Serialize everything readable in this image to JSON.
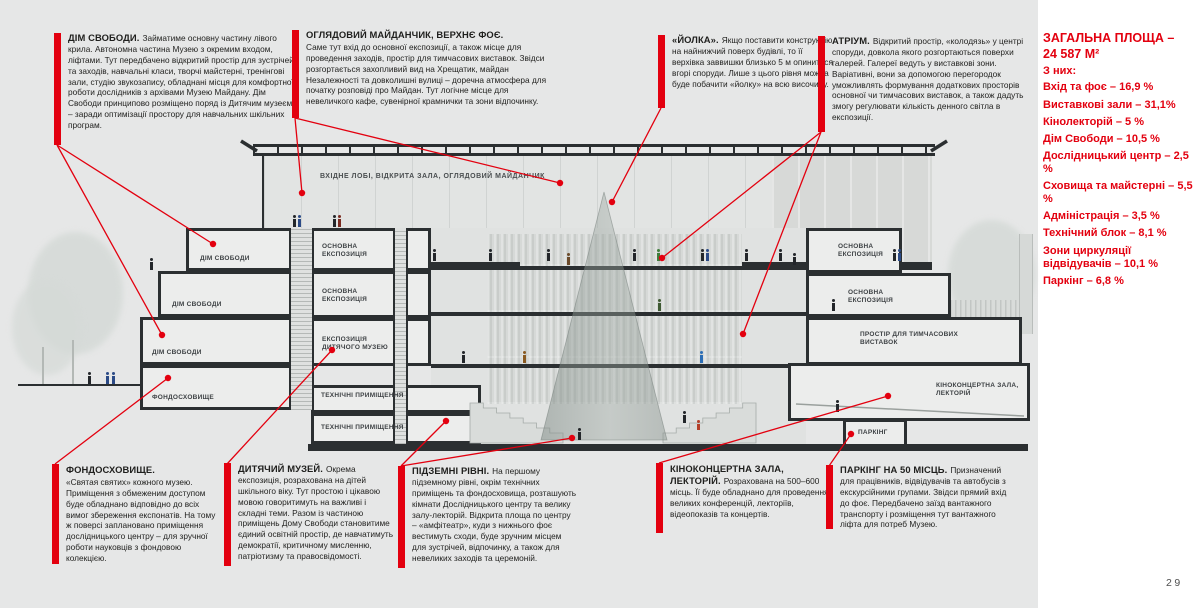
{
  "page": {
    "number": "29",
    "background": "#e6e7e7",
    "accent_red": "#e3000f"
  },
  "annotations_top": [
    {
      "title": "ДІМ СВОБОДИ.",
      "body": "Займатиме основну частину лівого крила. Автономна частина Музею з окремим входом, ліфтами. Тут передбачено відкритий простір для зустрічей та заходів, навчальні класи, творчі майстерні, тренінгові зали, студію звукозапису, обладнані місця для комфортної роботи дослідників з архівами Музею Майдану. Дім Свободи принципово розміщено поряд із Дитячим музеєм – заради оптимізації простору для навчальних шкільних програм."
    },
    {
      "title": "ОГЛЯДОВИЙ МАЙДАНЧИК, ВЕРХНЄ ФОЄ.",
      "body": "Саме тут вхід до основної експозиції, а також місце для проведення заходів, простір для тимчасових виставок. Звідси розгортається захопливий вид на Хрещатик, майдан Незалежності та довколишні вулиці – доречна атмосфера для початку розповіді про Майдан. Тут логічне місце для невеличкого кафе, сувенірної крамнички та зони відпочинку."
    },
    {
      "title": "«ЙОЛКА».",
      "body": "Якщо поставити конструкцію на найнижчий поверх будівлі, то її верхівка заввишки близько 5 м опиниться вгорі споруди. Лише з цього рівня можна буде побачити «йолку» на всю височину."
    },
    {
      "title": "АТРІУМ.",
      "body": "Відкритий простір, «колодязь» у центрі споруди, довкола якого розгортаються поверхи галерей. Галереї ведуть у виставкові зони. Варіативні, вони за допомогою перегородок уможливлять формування додаткових просторів основної чи тимчасових виставок, а також дадуть змогу регулювати кількість денного світла в експозиції."
    }
  ],
  "annotations_bottom": [
    {
      "title": "ФОНДОСХОВИЩЕ.",
      "body": "«Святая святих» кожного музею. Приміщення з обмеженим доступом буде обладнано відповідно до всіх вимог збереження експонатів. На тому ж поверсі заплановано приміщення дослідницького центру – для зручної роботи науковців з фондовою колекцією."
    },
    {
      "title": "ДИТЯЧИЙ МУЗЕЙ.",
      "body": "Окрема експозиція, розрахована на дітей шкільного віку. Тут простою і цікавою мовою говоритимуть на важливі і складні теми. Разом із частиною приміщень Дому Свободи становитиме єдиний освітній простір, де навчатимуть демократії, критичному мисленню, патріотизму та правосвідомості."
    },
    {
      "title": "ПІДЗЕМНІ РІВНІ.",
      "body": "На першому підземному рівні, окрім технічних приміщень та фондосховища, розташують кімнати Дослідницького центру та велику залу-лекторій. Відкрита площа по центру – «амфітеатр», куди з нижнього фоє вестимуть сходи, буде зручним місцем для зустрічей, відпочинку, а також для невеликих заходів та церемоній."
    },
    {
      "title": "КІНОКОНЦЕРТНА ЗАЛА, ЛЕКТОРІЙ.",
      "body": "Розрахована на 500–600 місць. Її буде обладнано для проведення великих конференцій, лекторіїв, відеопоказів та концертів."
    },
    {
      "title": "ПАРКІНГ НА 50 МІСЦЬ.",
      "body": "Призначений для працівників, відвідувачів та автобусів з екскурсійними групами. Звідси прямий вхід до фоє. Передбачено заїзд вантажного транспорту і розміщення тут вантажного ліфта для потреб Музею."
    }
  ],
  "area_summary": {
    "title_line1": "ЗАГАЛЬНА ПЛОЩА –",
    "title_line2": "24 587 М²",
    "subtitle": "З них:",
    "items": [
      "Вхід та фоє – 16,9 %",
      "Виставкові зали – 31,1%",
      "Кінолекторій – 5 %",
      "Дім Свободи – 10,5 %",
      "Дослідницький центр – 2,5 %",
      "Сховища та майстерні – 5,5 %",
      "Адміністрація – 3,5 %",
      "Технічний блок – 8,1 %",
      "Зони циркуляції відвідувачів – 10,1 %",
      "Паркінг – 6,8 %"
    ]
  },
  "section_labels": {
    "upper_foyer": "ВХІДНЕ ЛОБІ, ВІДКРИТА ЗАЛА, ОГЛЯДОВИЙ МАЙДАНЧИК",
    "dim_svobody": "ДІМ СВОБОДИ",
    "fondoskhovyshche": "ФОНДОСХОВИЩЕ",
    "osnovna_ekspozytsiia": "ОСНОВНА ЕКСПОЗИЦІЯ",
    "dytiachyi_muzei": "ЕКСПОЗИЦІЯ ДИТЯЧОГО МУЗЕЮ",
    "tekhnichni": "ТЕХНІЧНІ ПРИМІЩЕННЯ",
    "tymchasovi": "ПРОСТІР ДЛЯ ТИМЧАСОВИХ ВИСТАВОК",
    "kino": "КІНОКОНЦЕРТНА ЗАЛА, ЛЕКТОРІЙ",
    "parking": "ПАРКІНГ"
  }
}
